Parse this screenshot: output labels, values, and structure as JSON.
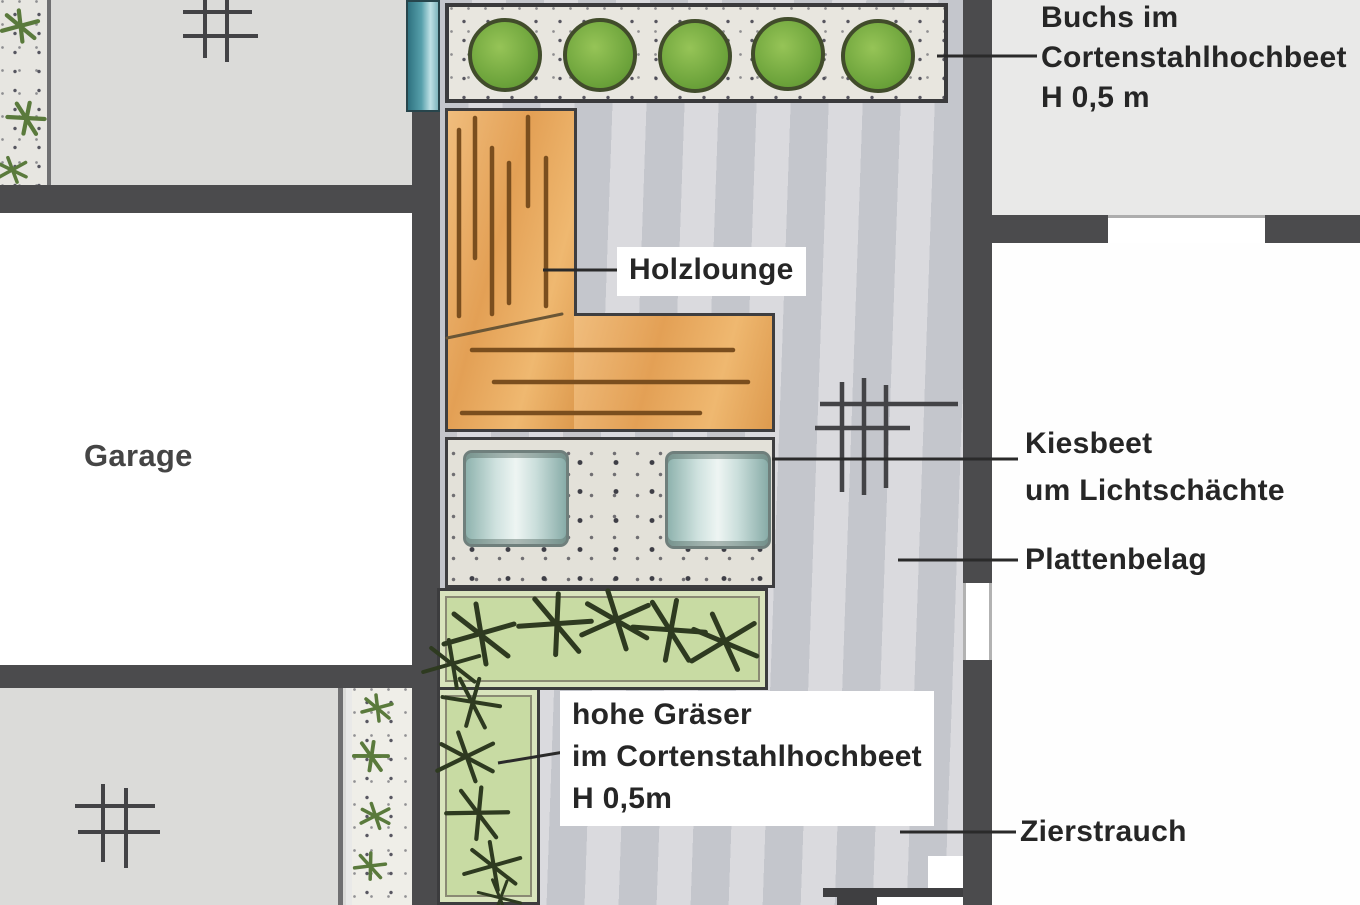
{
  "plan_title": "Garden landscape plan (scanned drawing, German labels)",
  "labels": {
    "buchs": [
      "Buchs im",
      "Cortenstahlhochbeet",
      "H 0,5 m"
    ],
    "holzlounge": "Holzlounge",
    "kiesbeet": [
      "Kiesbeet",
      "um Lichtschächte"
    ],
    "plattenbelag": "Plattenbelag",
    "garage": "Garage",
    "graeser": [
      "hohe Gräser",
      "im Cortenstahlhochbeet",
      "H 0,5m"
    ],
    "zierstrauch": "Zierstrauch"
  },
  "icons": {
    "drain": "hash-grid-drain-symbol",
    "grass": "asterisk-grass-tuft",
    "shrub": "small-green-sprig",
    "boxwood": "green-circle-ball",
    "light_shaft": "teal-cylinder"
  },
  "colors": {
    "wall": "#4b4b4d",
    "paving_light": "#dbdbd9",
    "paving_central": "#cdced3",
    "room_white": "#ffffff",
    "label_area": "#e9e9e8",
    "wood": "#e7a95f",
    "wood_stroke": "#7a4e1e",
    "boxwood_green": "#6ba23a",
    "grass_bed": "#c8dba3",
    "grass_stroke": "#2e3a20",
    "gravel": "#e3e1d9",
    "light_shaft_teal": "#cfe2df",
    "teal_band": "#57a0ab",
    "leader_line": "#2a2a2a"
  }
}
